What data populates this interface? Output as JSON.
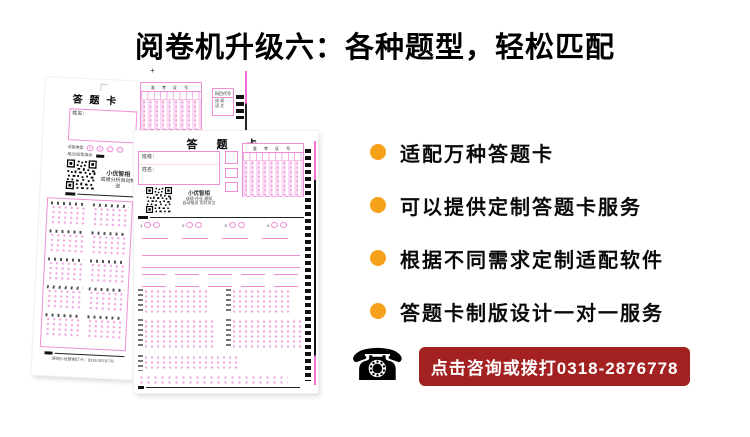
{
  "title": "阅卷机升级六：各种题型，轻松匹配",
  "features": [
    {
      "text": "适配万种答题卡"
    },
    {
      "text": "可以提供定制答题卡服务"
    },
    {
      "text": "根据不同需求定制适配软件"
    },
    {
      "text": "答题卡制版设计一对一服务"
    }
  ],
  "contact": {
    "phone_icon": "☎",
    "banner_text": "点击咨询或拨打0318-2876778",
    "phone_number": "0318-2876778"
  },
  "colors": {
    "bullet_orange": "#F5A119",
    "banner_red": "#A42121",
    "sheet_pink": "#EE8FD8"
  },
  "sheet_left": {
    "title": "答 题 卡",
    "name_label": "姓名：",
    "paper_type_label": "试卷类型",
    "paper_type_options": [
      "A",
      "B",
      "C",
      "D"
    ],
    "pencil_note": "用2B铅笔填涂",
    "qr_caption_line1": "小优智相",
    "qr_caption_line2": "成绩分析自动推送",
    "footer_note": "咨询小优智相订卡：0318-2876778"
  },
  "sheet_main": {
    "title": "答 题 卡",
    "class_label": "班级：",
    "name_label": "姓名：",
    "exam_no_label": "准 考 证 号",
    "qr_caption_line1": "小优智相",
    "qr_caption_line2": "成绩 作业 通知",
    "qr_caption_line3": "自动推送 实时关注",
    "tf_numbers": [
      "1",
      "2",
      "3",
      "4"
    ],
    "plus_mark": "+"
  },
  "sheet_fragment": {
    "exam_no_label": "准 考 证 号",
    "subject_label": "科目代号",
    "subject_rows": [
      "成 绩",
      "语 文"
    ],
    "plus_mark": "+"
  }
}
